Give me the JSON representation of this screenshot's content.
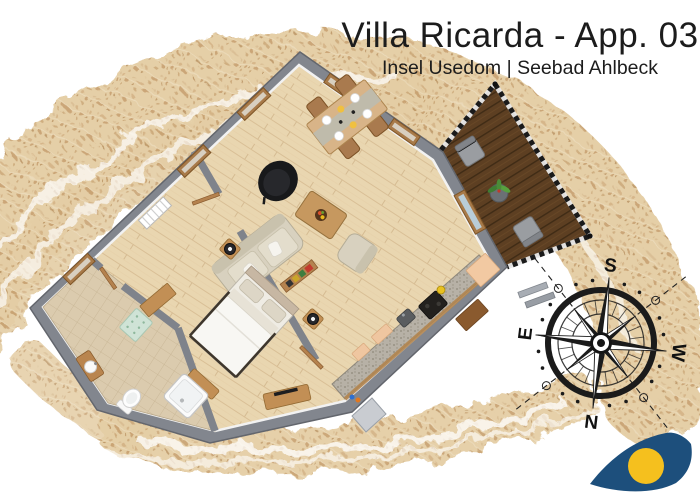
{
  "header": {
    "title": "Villa Ricarda - App. 03",
    "subtitle": "Insel Usedom | Seebad Ahlbeck"
  },
  "compass": {
    "top": "S",
    "right": "W",
    "bottom": "N",
    "left": "E"
  },
  "icons": {
    "compass_rose": "compass-rose",
    "logo": "wave-eye-logo"
  },
  "palette": {
    "sand": "#e4cda4",
    "wall_gray": "#82868e",
    "wood_floor": "#e9d6b0",
    "deck_brown": "#5d3f22",
    "bathroom_tile": "#dbcbae",
    "counter_gray": "#b7b1a6",
    "furniture_wood": "#c28f55",
    "logo_blue": "#1d4f7c",
    "logo_yellow": "#f5c01e",
    "text_dark": "#1c1c1c"
  }
}
